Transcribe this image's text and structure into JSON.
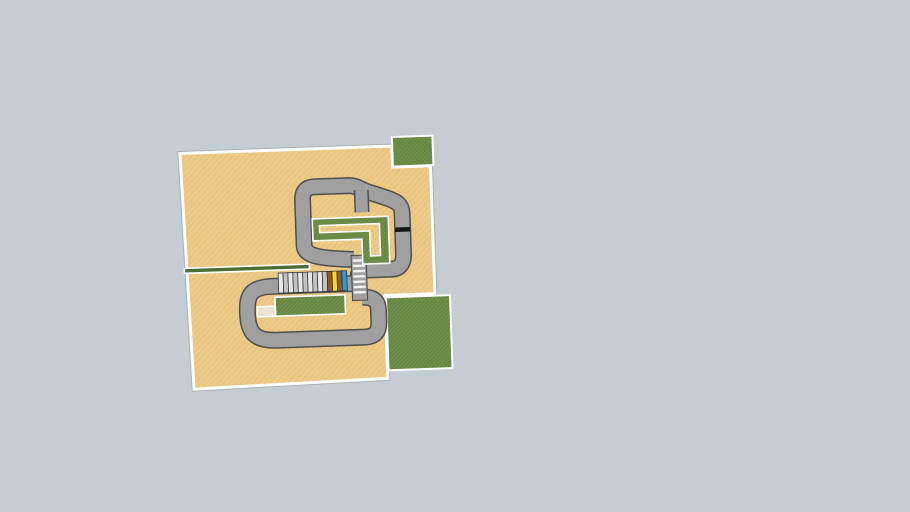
{
  "scene": {
    "description": "Top-down 3D viewport of a go-kart race track model on a plain blue-gray canvas",
    "background_color": "#c4ced2",
    "model_rotation_deg": -2,
    "colors": {
      "ground": "#ecca87",
      "ground_hatch": "#dcb66a",
      "grass": "#6f9049",
      "grass_hatch": "#597a39",
      "track": "#a0a0a0",
      "track_edge": "#4f4f4f",
      "curb_white": "#ffffff",
      "hedge": "#4c6e33",
      "start_line": "#161616",
      "grid_stripe": "#f2f2f2",
      "pit_wall": "#e9e2cf"
    },
    "elements": [
      "ground-field",
      "grass-field-top-right",
      "grass-field-bottom-right",
      "hedge-strip",
      "track-lower-loop",
      "track-upper-loop",
      "track-chicane-stub",
      "start-grid-section",
      "grass-island-l-shape",
      "grass-island-pit",
      "pit-wall-tail",
      "pit-garages",
      "start-finish-line"
    ]
  },
  "start_grid": {
    "stripe_count": 7
  },
  "garages": {
    "x0": 278,
    "y": 272,
    "stall_width": 4.9,
    "height": 20,
    "stalls": [
      {
        "name": "stall-1",
        "color": "#e8e8e8"
      },
      {
        "name": "stall-2",
        "color": "#c2c2c2"
      },
      {
        "name": "stall-3",
        "color": "#e8e8e8"
      },
      {
        "name": "stall-4",
        "color": "#c2c2c2"
      },
      {
        "name": "stall-5",
        "color": "#e8e8e8"
      },
      {
        "name": "stall-6",
        "color": "#c2c2c2"
      },
      {
        "name": "stall-7",
        "color": "#e8e8e8"
      },
      {
        "name": "stall-8",
        "color": "#c2c2c2"
      },
      {
        "name": "stall-9",
        "color": "#e8e8e8"
      },
      {
        "name": "stall-10",
        "color": "#c2c2c2"
      },
      {
        "name": "stall-brown-1",
        "color": "#8a5a2b"
      },
      {
        "name": "stall-yellow",
        "color": "#f3df00"
      },
      {
        "name": "stall-brown-2",
        "color": "#8a5a2b"
      },
      {
        "name": "stall-blue",
        "color": "#2e9add"
      }
    ]
  }
}
